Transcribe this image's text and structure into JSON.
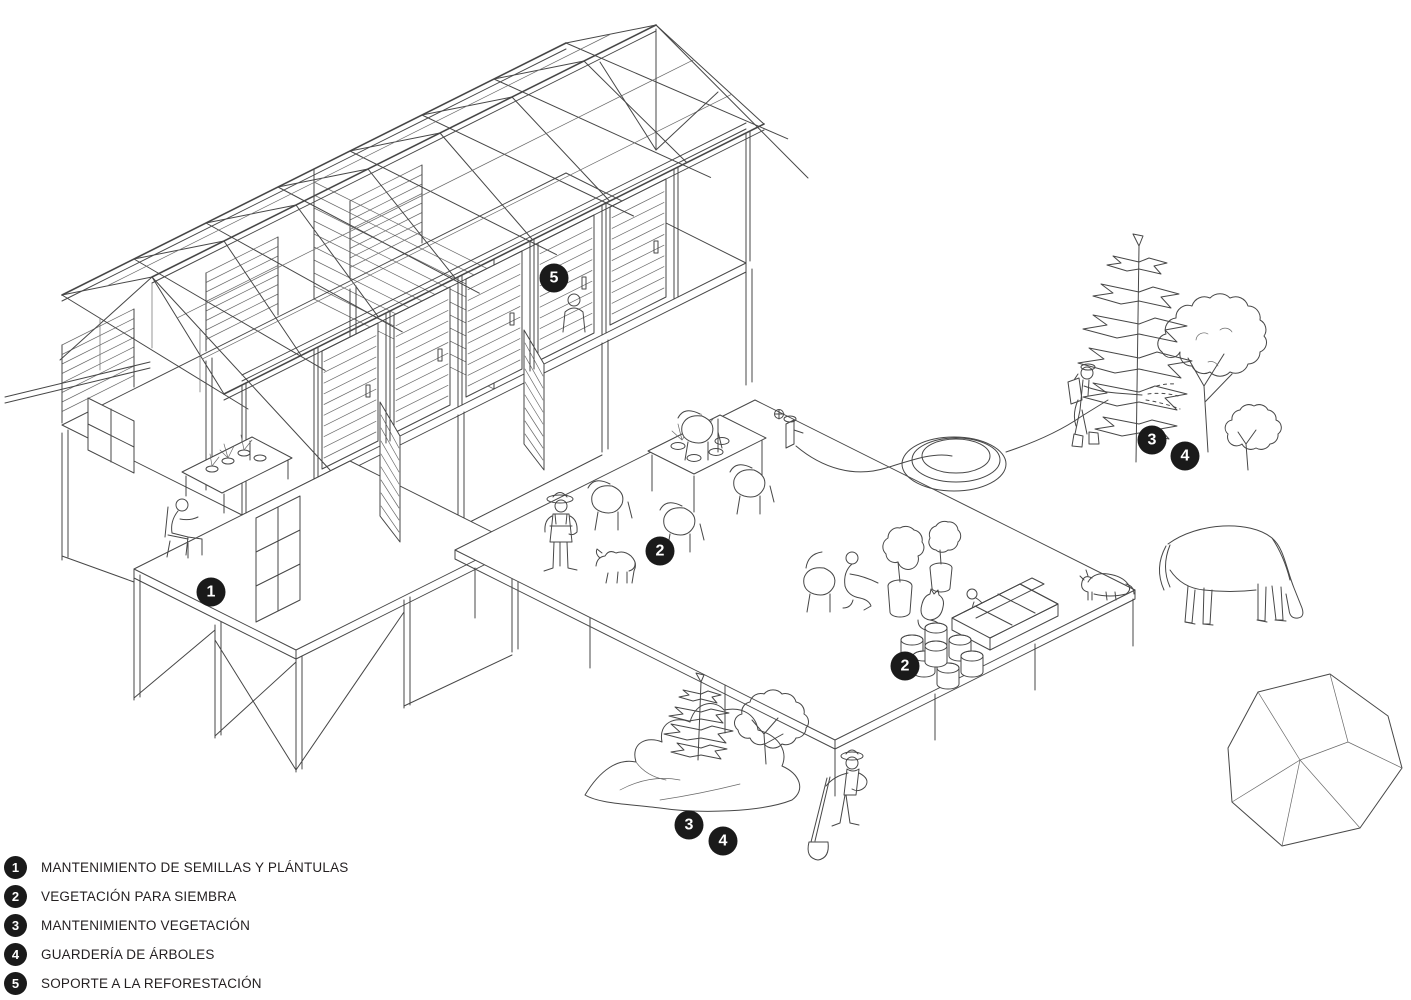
{
  "scene": {
    "background": "#ffffff",
    "ink_color": "#474747",
    "marker_bg": "#1a1a1a",
    "marker_fg": "#ffffff",
    "description_elements": [
      "timber-frame-building",
      "left-porch-deck",
      "main-work-deck",
      "seedling-bench",
      "dining-table",
      "work-tables",
      "seed-tray",
      "seedling-cylinders",
      "garden-hose",
      "water-spigot",
      "araucaria-trees",
      "shrubs",
      "terrain-mound",
      "boulder",
      "farmer-figure",
      "seated-worker",
      "potting-worker",
      "child-figure",
      "sprayer-figure",
      "shovel-figure",
      "interior-figure",
      "horse",
      "small-dog",
      "farm-dog",
      "cat"
    ]
  },
  "legend": {
    "items": [
      {
        "num": "1",
        "label": "MANTENIMIENTO DE SEMILLAS Y PLÁNTULAS"
      },
      {
        "num": "2",
        "label": "VEGETACIÓN PARA SIEMBRA"
      },
      {
        "num": "3",
        "label": "MANTENIMIENTO VEGETACIÓN"
      },
      {
        "num": "4",
        "label": "GUARDERÍA DE ÁRBOLES"
      },
      {
        "num": "5",
        "label": "SOPORTE A LA REFORESTACIÓN"
      }
    ]
  },
  "canvas_markers": [
    {
      "num": "1",
      "x": 211,
      "y": 592
    },
    {
      "num": "5",
      "x": 554,
      "y": 278
    },
    {
      "num": "2",
      "x": 660,
      "y": 551
    },
    {
      "num": "2",
      "x": 905,
      "y": 666
    },
    {
      "num": "3",
      "x": 1152,
      "y": 440
    },
    {
      "num": "4",
      "x": 1185,
      "y": 456
    },
    {
      "num": "3",
      "x": 689,
      "y": 825
    },
    {
      "num": "4",
      "x": 723,
      "y": 841
    }
  ]
}
